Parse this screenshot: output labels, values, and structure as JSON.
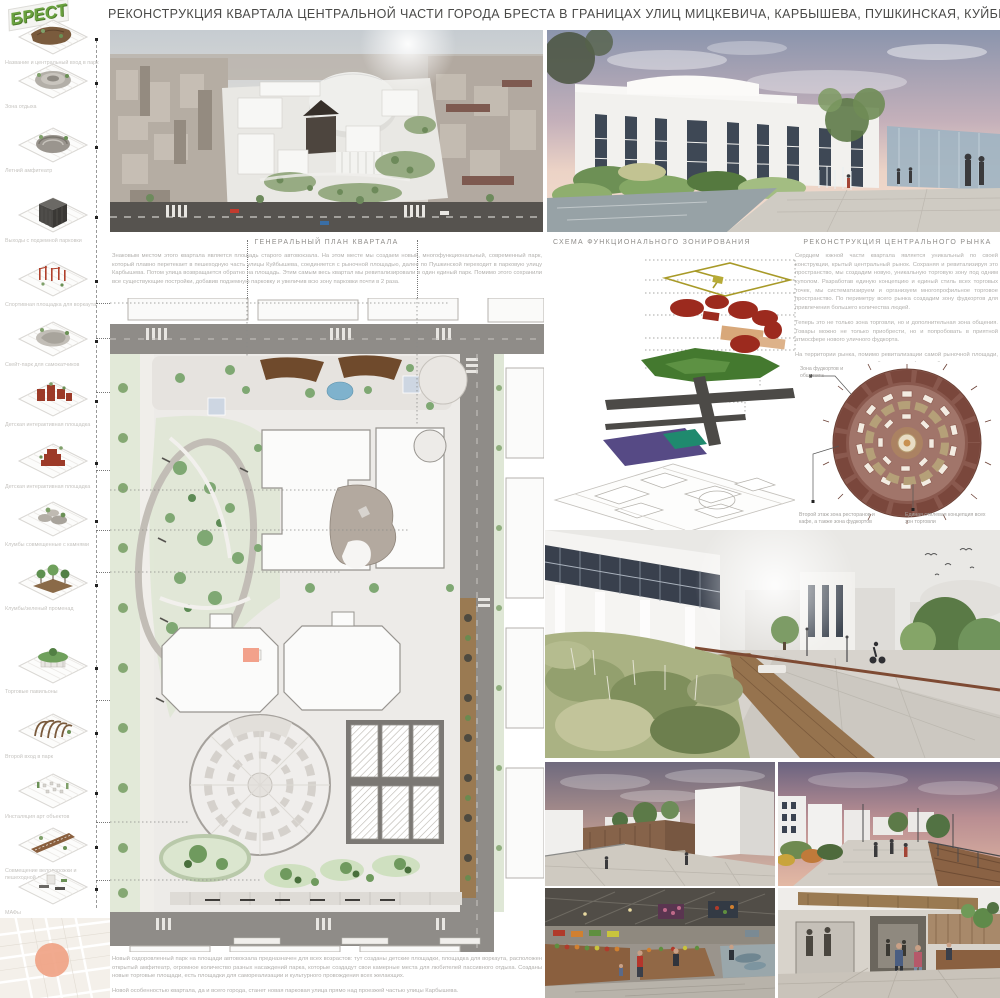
{
  "logo": {
    "text": "БРЕСТ"
  },
  "title": "РЕКОНСТРУКЦИЯ КВАРТАЛА ЦЕНТРАЛЬНОЙ ЧАСТИ ГОРОДА БРЕСТА В ГРАНИЦАХ УЛИЦ МИЦКЕВИЧА, КАРБЫШЕВА, ПУШКИНСКАЯ, КУЙБЫШЕВА",
  "sidebar": {
    "items": [
      "Название и центральный вход в парк",
      "Зона отдыха",
      "Летний амфитеатр",
      "Выходы с подземной парковки",
      "Спортивная площадка для воркаута",
      "Скейт-парк для самокатчиков",
      "Детская интерактивная площадка",
      "Детская интерактивная площадка",
      "Клумбы совмещенные с камнями",
      "Клумбы/зеленый променад",
      "Торговые павильоны",
      "Второй вход в парк",
      "Инсталяция арт объектов",
      "Совмещение велодорожки и пешеходной дорожки",
      "МАФы"
    ]
  },
  "sections": {
    "general_plan": {
      "header": "ГЕНЕРАЛЬНЫЙ ПЛАН КВАРТАЛА",
      "intro": "Знаковым местом этого квартала является площадь старого автовокзала. На этом месте мы создаем новый, многофункциональный, современный парк, который плавно перетекает в пешеходную часть улицы Куйбышева, соединяется с рыночной площадью, далее по Пушкинской переходит в парковую улицу Карбышева. Потом улица возвращается обратно на площадь. Этим самым весь квартал мы ревитализировали в один единый парк. Помимо этого сохранили все существующие постройки, добавив подземную парковку и увеличив всю зону парковки почти в 2 раза."
    },
    "zoning": {
      "header": "СХЕМА ФУНКЦИОНАЛЬНОГО ЗОНИРОВАНИЯ",
      "legend": [
        "Парковая улица и 2 этаж торговых/общ. зоны",
        "Торговые помещения",
        "Открытая парковка и торговля на 2 этаже",
        "Парково-рекреационные территории",
        "Пешеходные дорожки",
        "Автомобильные дороги",
        "Подземная парковка (1 очередь)",
        "Подземная парковка (2 очередь)"
      ]
    },
    "market": {
      "header": "РЕКОНСТРУКЦИЯ ЦЕНТРАЛЬНОГО РЫНКА",
      "paragraphs": {
        "p1": "Сердцем южной части квартала является уникальный по своей конструкции, крытый центральный рынок. Сохраняя и ревитализируя это пространство, мы создадим новую, уникальную торговую зону под одним куполом. Разработав единую концепцию и единый стиль всех торговых точек, мы систематизируем и организуем многопрофильное торговое пространство. По периметру всего рынка создадим зону фудкортов для привлечения большего количества людей.",
        "p2": "Теперь это не только зона торговли, но и дополнительная зона общения. Товары можно не только приобрести, но и попробовать в приятной атмосфере нового уличного фудкорта.",
        "p3": "На территории рынка, помимо ревитализации самой рыночной площади, мы создадим дополнительный пешеходно/торговый путь, увеличивая и зону торговли, и привлекательность самих торговых павильонов. Новые пешеходные пути не только упрощают движение в центральной части города, но и создают более привлекательный торговый климат для всех организаций/арендаторов на территории рынка."
      },
      "labels": {
        "foodcourt": "Зона фудкортов и общепита",
        "second_floor": "Второй этаж зона ресторанов и кафе, а также зона фудкортов",
        "style": "Единая стилевая концепция всех зон торговли"
      }
    }
  },
  "footer": {
    "p1": "Новый оздоровленный парк на площади автовокзала предназначен для всех возрастов: тут созданы детские площадки, площадка для воркаута, расположен открытый амфитеатр, огромное количество разных насаждений парка, которые создадут свои камерные места для любителей пассивного отдыха. Созданы новые торговые площади, есть площадки для самореализации и культурного провождения всех желающих.",
    "p2": "Новой особенностью квартала, да и всего города, станет новая парковая улица прямо над проезжей частью улицы Карбышева."
  },
  "colors": {
    "accent_red": "#9c2a1e",
    "accent_green": "#44792f",
    "accent_purple": "#564a85",
    "accent_teal": "#1f8a6e",
    "accent_tan": "#d8a87a",
    "accent_olive": "#a89a28",
    "map_highlight": "#f0a183"
  }
}
